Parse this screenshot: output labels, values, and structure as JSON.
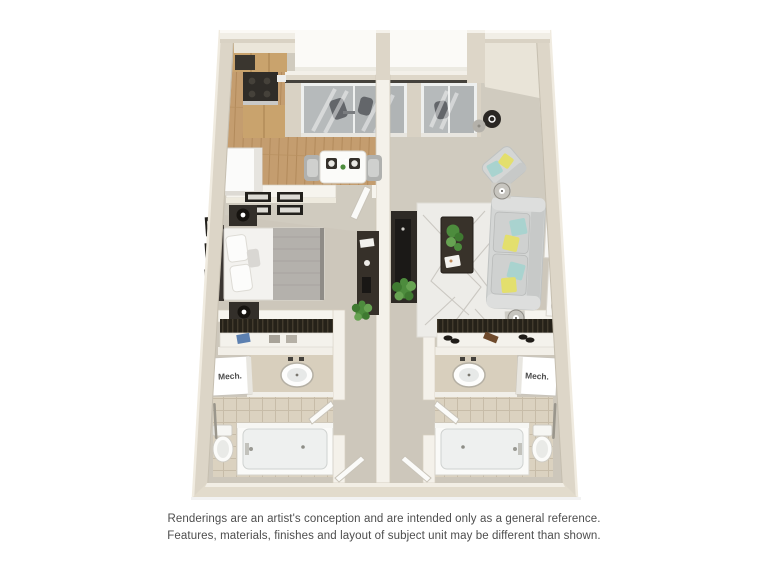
{
  "window": {
    "width": 768,
    "height": 576,
    "background": "#ffffff"
  },
  "floorplan": {
    "kind": "3d-rendered-apartment-floor-plan",
    "labels": {
      "mech_left": "Mech.",
      "mech_right": "Mech."
    },
    "palette": {
      "wall_side": "#dcd5c7",
      "wall_top": "#f2efe7",
      "floor_main": "#cdc7bb",
      "floor_wood": "#c49d6f",
      "floor_tile": "#dbd2c0",
      "glass": "#b6babb",
      "dark_furniture": "#332f2a",
      "sofa_gray": "#d4d6d5",
      "pillow_teal": "#a9d3cf",
      "pillow_yellow": "#e3df6d",
      "plant_green": "#4d8c3d",
      "rug": "#edece8"
    }
  },
  "disclaimer": {
    "line1": "Renderings are an artist's conception and are intended only as a general reference.",
    "line2": "Features, materials, finishes and layout of subject unit may be different than shown."
  }
}
